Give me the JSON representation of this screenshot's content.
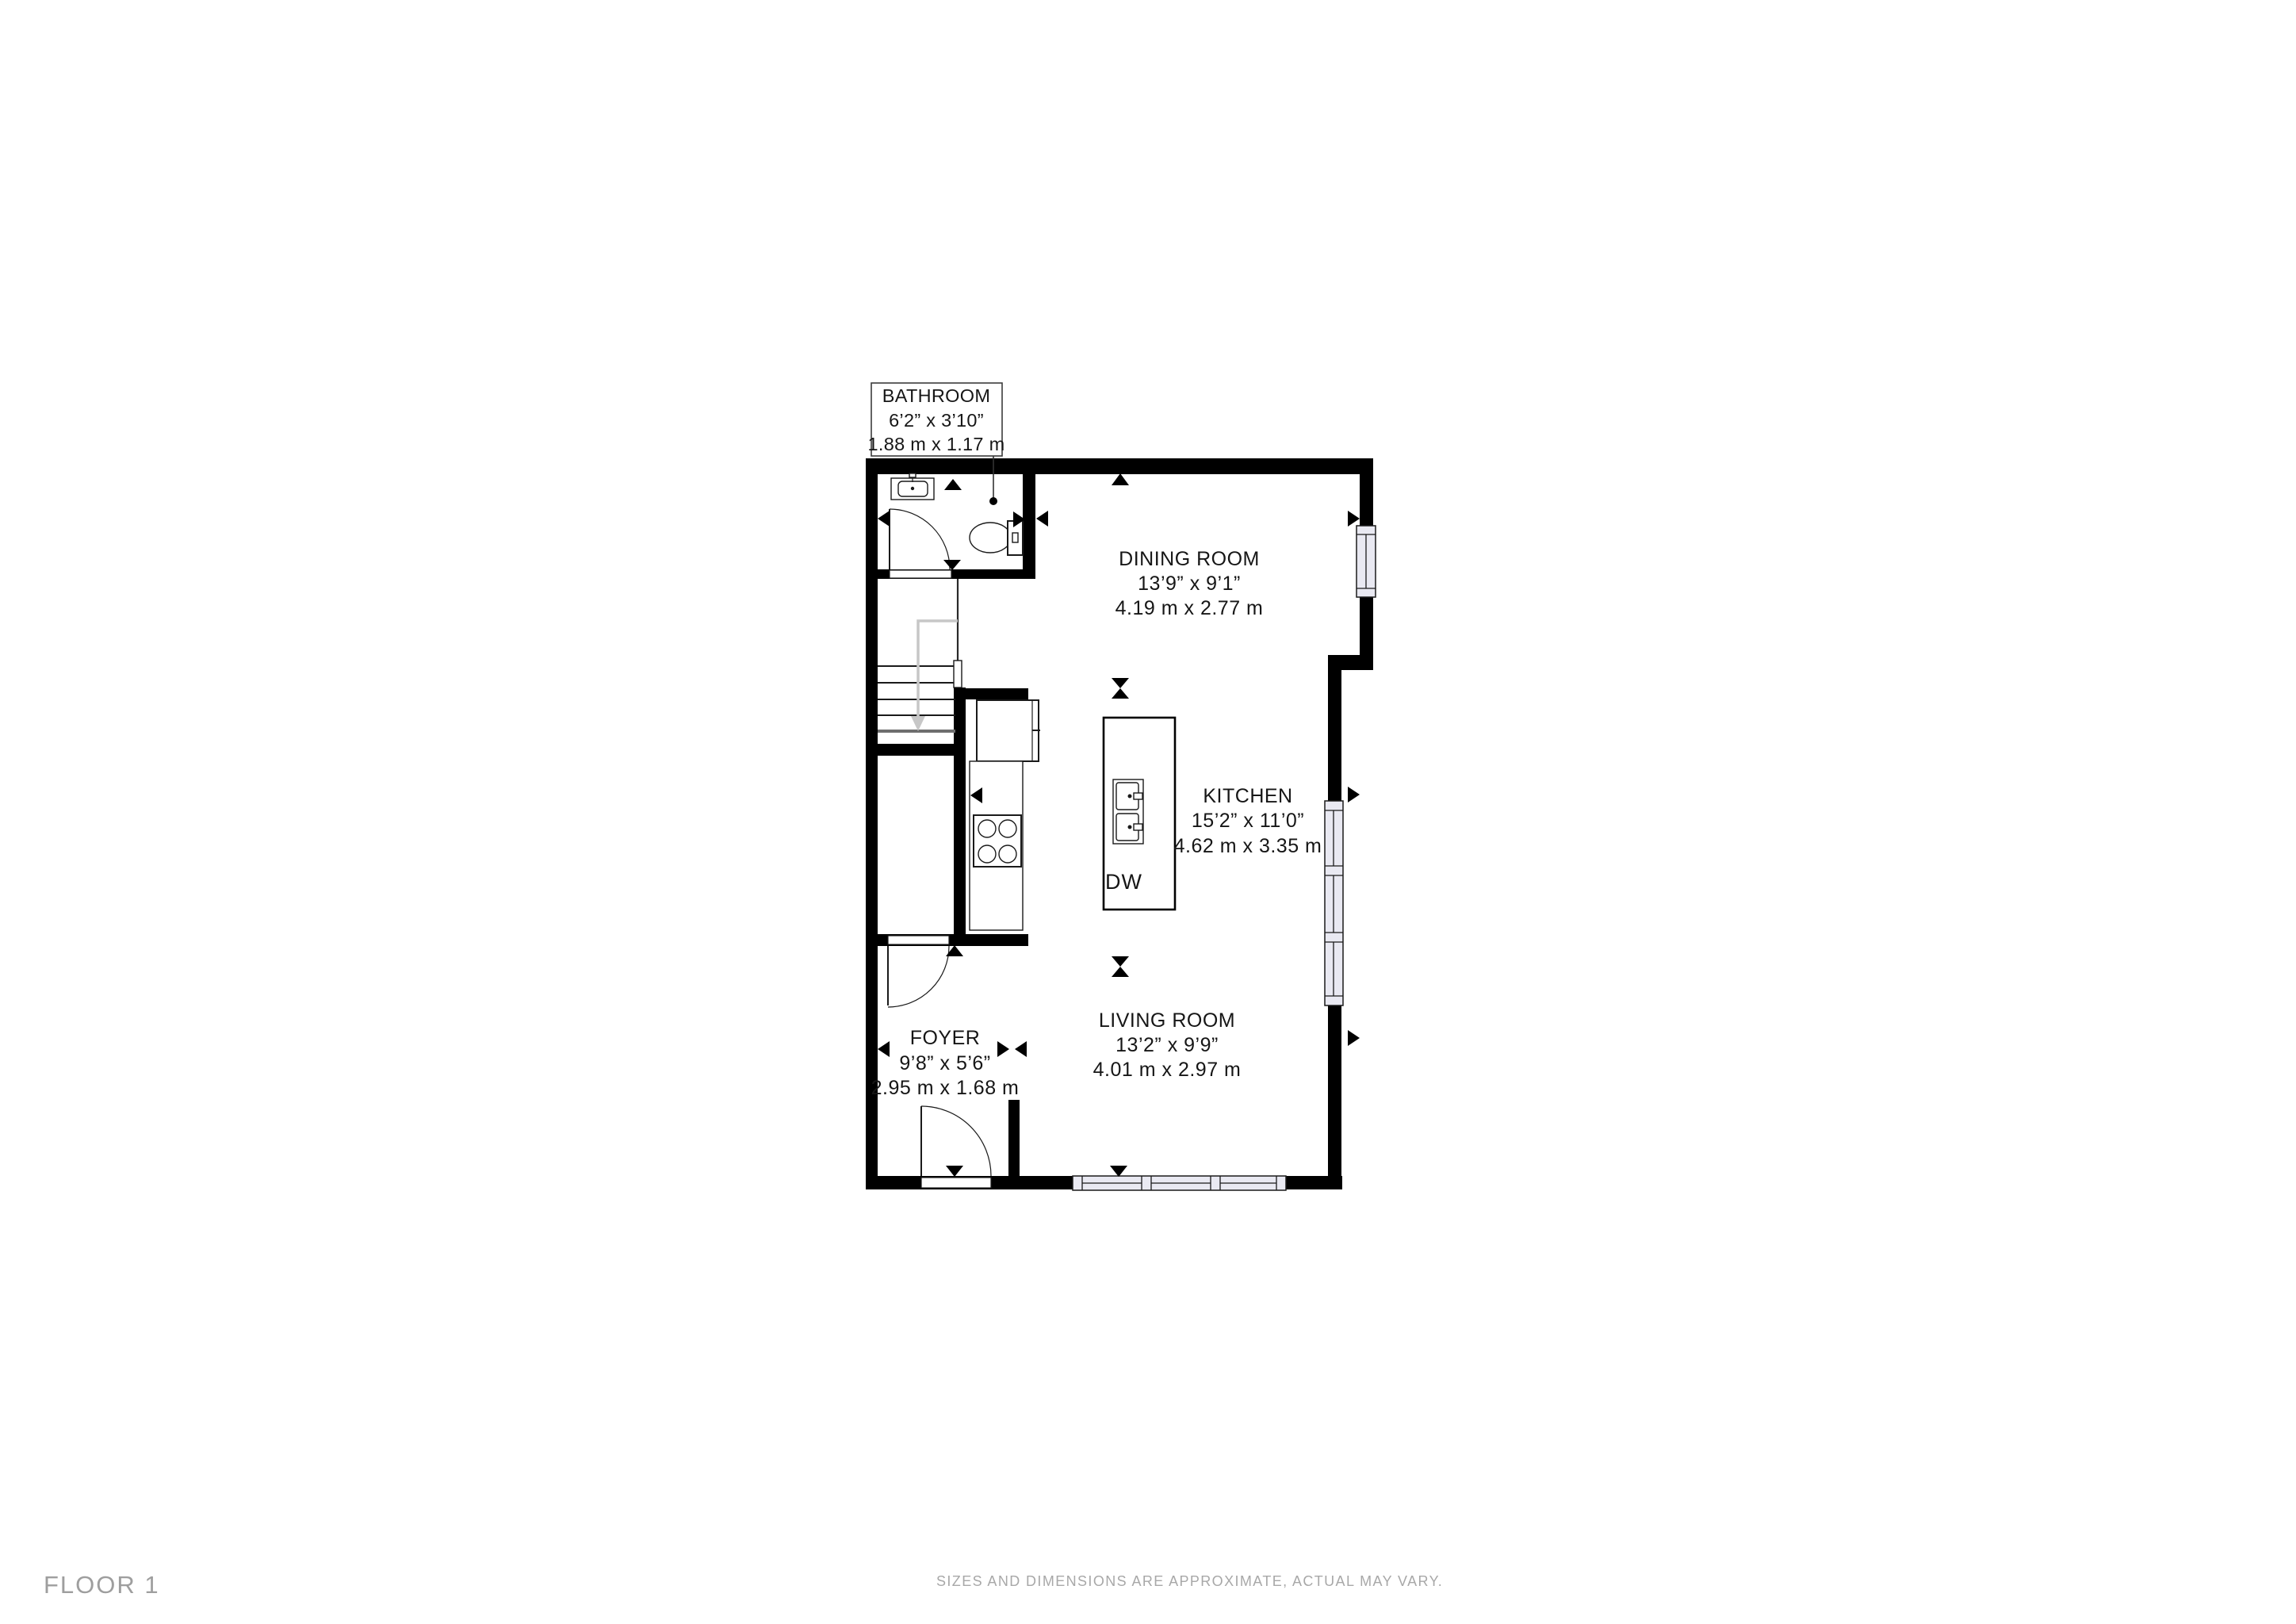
{
  "floor": {
    "label": "FLOOR 1"
  },
  "disclaimer": "SIZES AND DIMENSIONS ARE APPROXIMATE, ACTUAL MAY VARY.",
  "rooms": {
    "bathroom": {
      "name": "BATHROOM",
      "imperial": "6’2” x 3’10”",
      "metric": "1.88 m x 1.17 m"
    },
    "dining": {
      "name": "DINING ROOM",
      "imperial": "13’9” x 9’1”",
      "metric": "4.19 m x 2.77 m"
    },
    "kitchen": {
      "name": "KITCHEN",
      "imperial": "15’2” x 11’0”",
      "metric": "4.62 m x 3.35 m"
    },
    "living": {
      "name": "LIVING ROOM",
      "imperial": "13’2” x 9’9”",
      "metric": "4.01 m x 2.97 m"
    },
    "foyer": {
      "name": "FOYER",
      "imperial": "9’8” x 5’6”",
      "metric": "2.95 m x 1.68 m"
    }
  },
  "appliances": {
    "dishwasher_label": "DW"
  },
  "colors": {
    "wall": "#000000",
    "window": "#e9e9f2",
    "stair_arrow": "#c7c7c7",
    "gray_text": "#9e9e9e",
    "gray_text2": "#a8a8a8"
  }
}
